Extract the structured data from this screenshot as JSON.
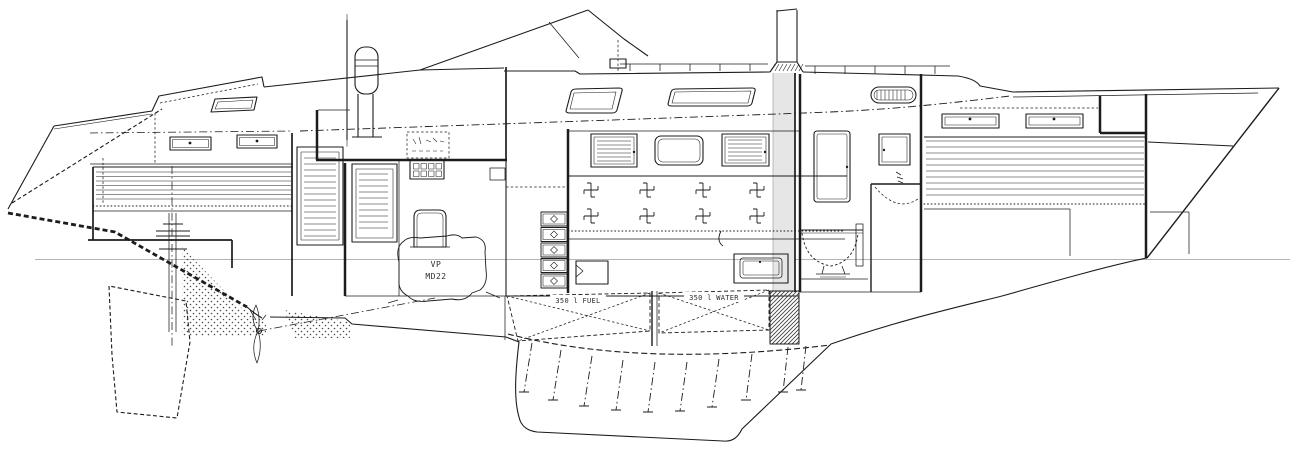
{
  "drawing": {
    "type": "technical drawing — sailing yacht longitudinal section (interior profile, side elevation)",
    "orientation": "bow to the right, stern to the left",
    "labels": {
      "engine_line1": "VP",
      "engine_line2": "MD22",
      "fuel_tank": "350 l FUEL",
      "water_tank": "350 l WATER"
    },
    "colors": {
      "ink": "#1c1c1c",
      "light": "#8f8f8f",
      "waterline": "#b4b4b4",
      "mast_fill": "#e6e6e6",
      "paper": "#ffffff"
    },
    "parts": [
      "transom",
      "aft double berth",
      "aft-cabin portlights",
      "aft deck hatch",
      "rudder (hidden outline)",
      "rudder stock and quadrant",
      "propeller and shaft",
      "cockpit with steering-wheel pedestal",
      "sprayhood / windscreen",
      "winch",
      "engine-room louvred doors",
      "instrument panel",
      "switch panel",
      "engine",
      "companionway bulkhead",
      "galley drawers",
      "saloon louvred lockers",
      "saloon portlight",
      "reading-light symbols",
      "settee drawers",
      "fuel tank with cross bracing",
      "fresh-water tank with cross bracing",
      "keel with ballast bolts",
      "mast sectioned at deck",
      "head compartment with mirror locker, cabinet, WC and door swing",
      "dorade vent",
      "forward V-berth",
      "forecabin portlights",
      "anchor locker",
      "bow stem",
      "waterline"
    ]
  }
}
